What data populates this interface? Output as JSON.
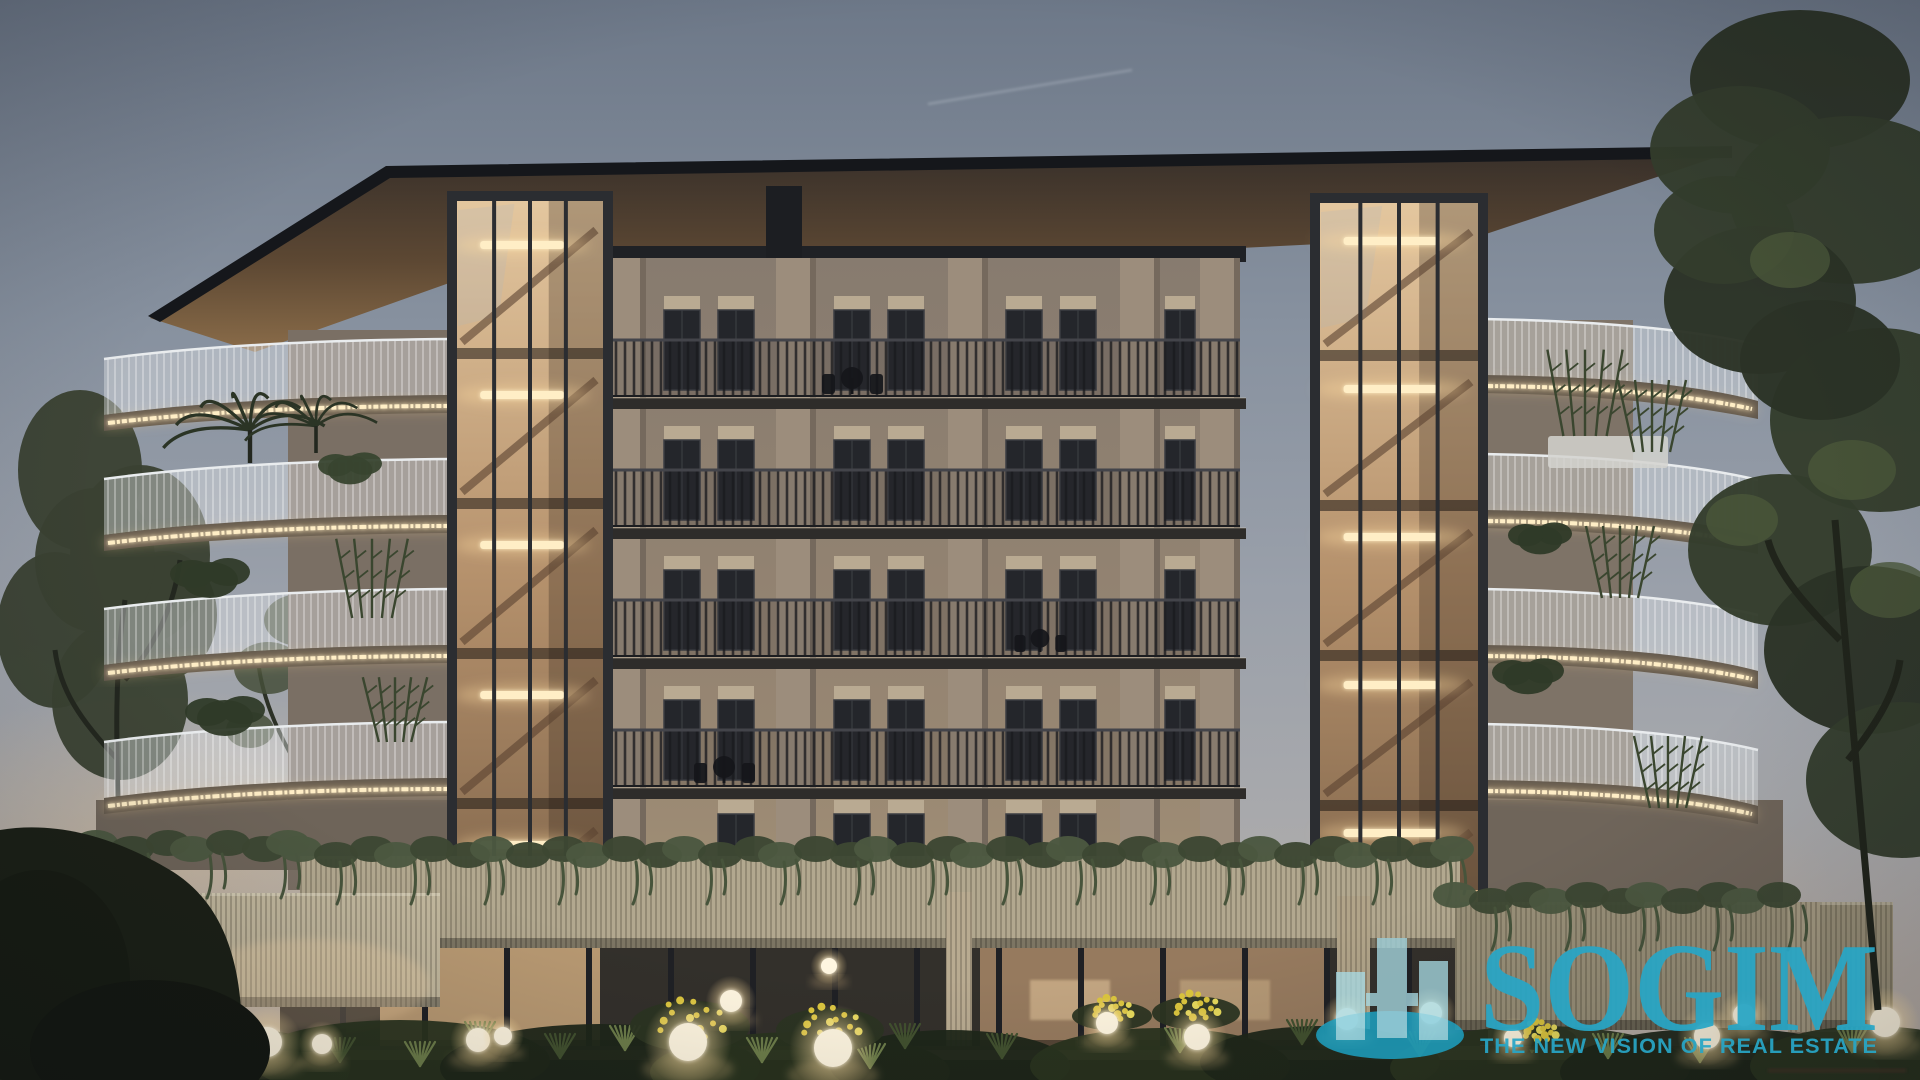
{
  "watermark": {
    "wordmark": "SOGIM",
    "tagline": "THE NEW VISION OF REAL ESTATE",
    "logo_icon": "buildings-skyline-icon"
  },
  "palette": {
    "accent_teal": "#28a6c6",
    "logo_bar_teal": "#a9dce6",
    "logo_ellipse_teal": "#1da2c3",
    "led_warm": "#ffeec6",
    "led_glow": "#ffd79a",
    "sky_top": "#6d7888",
    "sky_mid": "#9aa0aa",
    "sky_horizon": "#bdb2a7",
    "dusk_glow": "#d9bd97",
    "roof_dark": "#15171b",
    "soffit_warm": "#7c5f3f",
    "soffit_dark": "#38302a",
    "facade": "#877b6f",
    "facade_light": "#a39176",
    "pilaster": "#9c8d7c",
    "slab_dark": "#2e2c2a",
    "canopy_dark": "#1f2125",
    "glass_dark": "#24262b",
    "shutter": "#b9aa92",
    "tower_frame": "#2b2d31",
    "tower_glass_top": "#e4c79f",
    "tower_glass_bottom": "#6f5740",
    "stair_light": "#e8d9c2",
    "white_rail": "#e9ecee",
    "podium_wall": "#b2a88f",
    "podium_wall_light": "#c1b79d",
    "podium_wall_right": "#9a9179",
    "hedge_green": "#3d4733",
    "plant_green": "#2f3a28",
    "grass_dark": "#42512f",
    "grass_lit": "#6d7d4a",
    "flower_yellow": "#dcc63e",
    "lamp_core": "#fff6e0",
    "tree_dark": "#333d2c",
    "pavement": "#7a6c5c",
    "ground_dark": "#0e0c09"
  }
}
